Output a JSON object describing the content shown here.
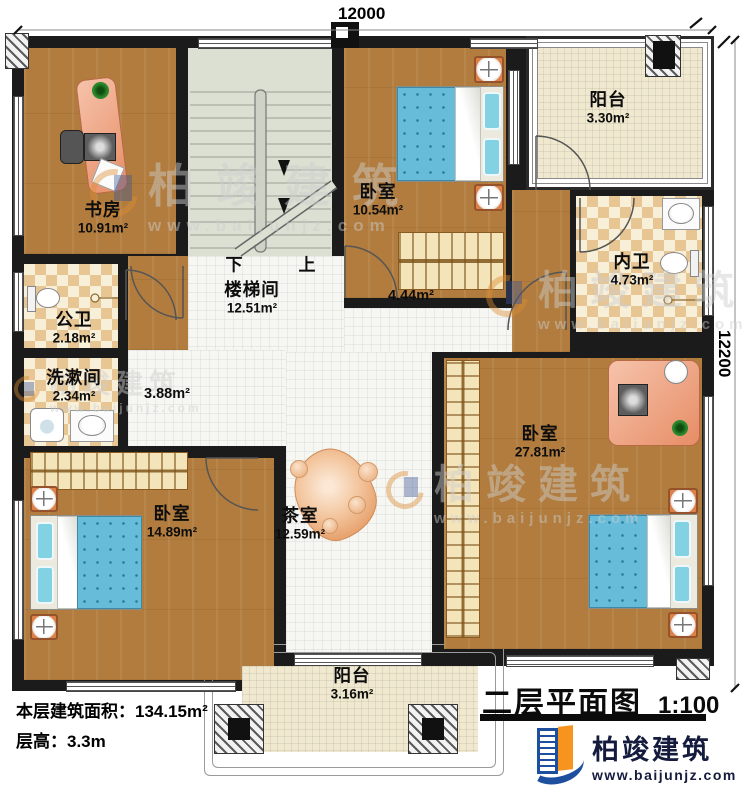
{
  "dimensions": {
    "top": "12000",
    "right": "12200"
  },
  "rooms": {
    "study": {
      "name": "书房",
      "area": "10.91m²"
    },
    "bedroom_top": {
      "name": "卧室",
      "area": "10.54m²"
    },
    "balcony_top": {
      "name": "阳台",
      "area": "3.30m²"
    },
    "inner_bath": {
      "name": "内卫",
      "area": "4.73m²"
    },
    "stairwell": {
      "name": "楼梯间",
      "area": "12.51m²"
    },
    "public_bath": {
      "name": "公卫",
      "area": "2.18m²"
    },
    "wash_room": {
      "name": "洗漱间",
      "area": "2.34m²"
    },
    "bedroom_left": {
      "name": "卧室",
      "area": "14.89m²"
    },
    "tea_room": {
      "name": "茶室",
      "area": "12.59m²"
    },
    "bedroom_right": {
      "name": "卧室",
      "area": "27.81m²"
    },
    "balcony_bottom": {
      "name": "阳台",
      "area": "3.16m²"
    }
  },
  "hall": {
    "area_right": "4.44m²",
    "area_left": "3.88m²"
  },
  "stairs": {
    "down": "下",
    "up": "上"
  },
  "info": {
    "floor_area_label": "本层建筑面积：",
    "floor_area_value": "134.15m²",
    "floor_height_label": "层高：",
    "floor_height_value": "3.3m"
  },
  "title_block": {
    "title": "二层平面图",
    "scale": "1:100"
  },
  "brand": {
    "name": "柏竣建筑",
    "website": "www.baijunjz.com"
  },
  "watermark": {
    "text": "柏竣建筑",
    "url": "www.baijunjz.com"
  },
  "colors": {
    "wall": "#1b1b1b",
    "wood": "#b17c3e",
    "hall_tile": "#f6f6f2",
    "balcony_tile": "#f0e9d0",
    "bath_checker": "#e7c693",
    "stairs": "#dbe0d3",
    "bed_blue": "#66bcd9",
    "furniture_orange": "#dd8146",
    "brand_blue": "#1d4f9e",
    "brand_orange": "#f7941d"
  }
}
